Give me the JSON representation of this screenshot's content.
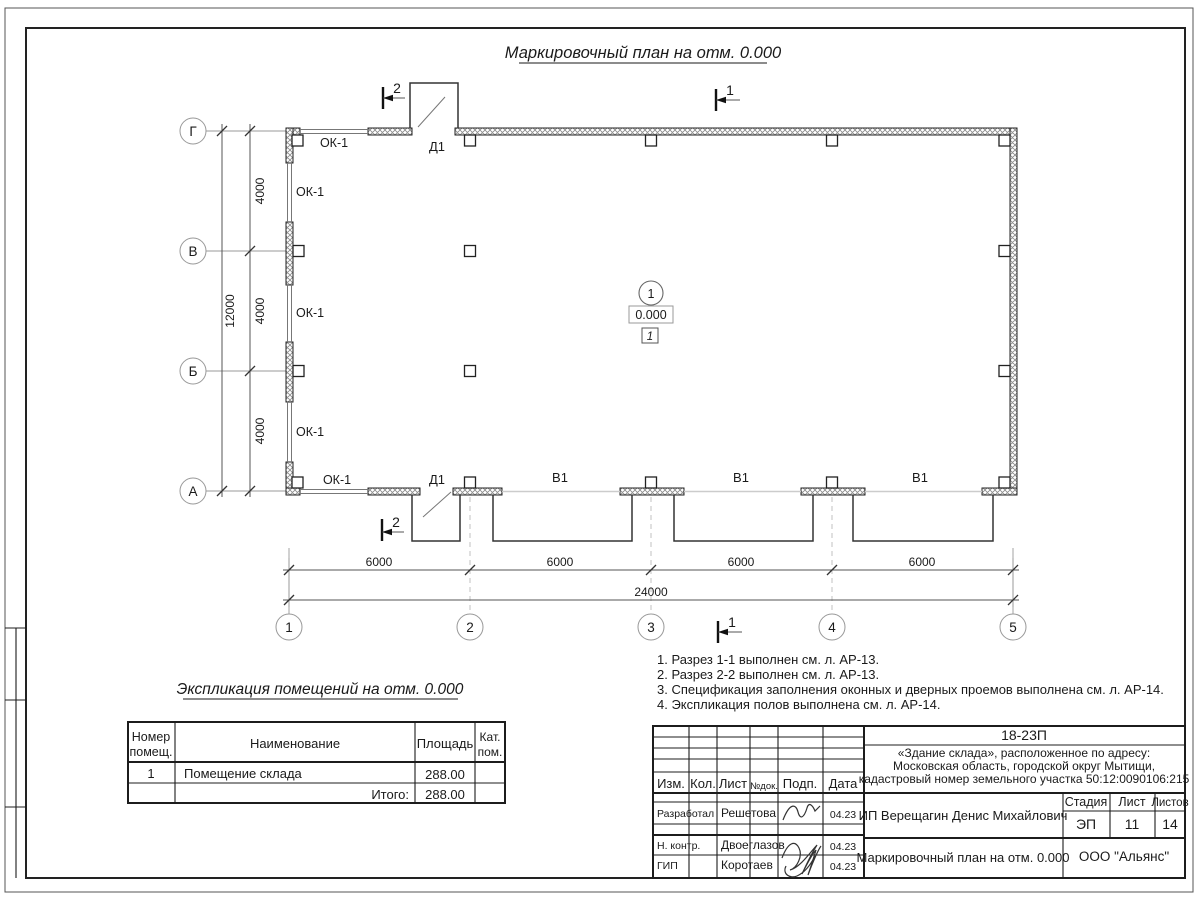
{
  "drawing": {
    "title": "Маркировочный план на отм. 0.000"
  },
  "plan": {
    "axis_numbers": [
      "1",
      "2",
      "3",
      "4",
      "5"
    ],
    "axis_letters": [
      "Г",
      "В",
      "Б",
      "А"
    ],
    "dims": {
      "bottom_segments": [
        "6000",
        "6000",
        "6000",
        "6000"
      ],
      "bottom_total": "24000",
      "left_segments": [
        "4000",
        "4000",
        "4000"
      ],
      "left_total": "12000"
    },
    "marks": {
      "window": "ОК-1",
      "door": "Д1",
      "gate": "В1"
    },
    "room": {
      "number": "1",
      "elevation": "0.000",
      "floor": "1"
    },
    "sections": {
      "one": "1",
      "two": "2"
    }
  },
  "notes": {
    "items": [
      "1. Разрез 1-1 выполнен см. л. АР-13.",
      "2. Разрез 2-2 выполнен см. л. АР-13.",
      "3. Спецификация заполнения оконных и дверных проемов выполнена см. л. АР-14.",
      "4. Экспликация полов выполнена см. л. АР-14."
    ]
  },
  "explication": {
    "title": "Экспликация помещений на отм. 0.000",
    "col_number_line1": "Номер",
    "col_number_line2": "помещ.",
    "col_name": "Наименование",
    "col_area": "Площадь",
    "col_cat_line1": "Кат.",
    "col_cat_line2": "пом.",
    "rows": [
      {
        "number": "1",
        "name": "Помещение склада",
        "area": "288.00",
        "cat": ""
      }
    ],
    "total_label": "Итого:",
    "total_area": "288.00"
  },
  "titleblock": {
    "doc_number": "18-23П",
    "object_line1": "«Здание склада», расположенное по адресу:",
    "object_line2": "Московская область, городской округ Мытищи,",
    "object_line3": "кадастровый номер земельного участка 50:12:0090106:215",
    "cols": {
      "izm": "Изм.",
      "kol": "Кол.",
      "list": "Лист",
      "doc": "№док.",
      "podp": "Подп.",
      "data": "Дата"
    },
    "rows": [
      {
        "role": "Разработал",
        "name": "Решетова",
        "date": "04.23"
      },
      {
        "role": "Н. контр.",
        "name": "Двоеглазов",
        "date": "04.23"
      },
      {
        "role": "ГИП",
        "name": "Коротаев",
        "date": "04.23"
      }
    ],
    "client": "ИП Верещагин Денис Михайлович",
    "stage_label": "Стадия",
    "sheet_label": "Лист",
    "sheets_label": "Листов",
    "stage": "ЭП",
    "sheet": "11",
    "sheets": "14",
    "sheet_title": "Маркировочный план на отм. 0.000",
    "company": "ООО \"Альянс\""
  }
}
